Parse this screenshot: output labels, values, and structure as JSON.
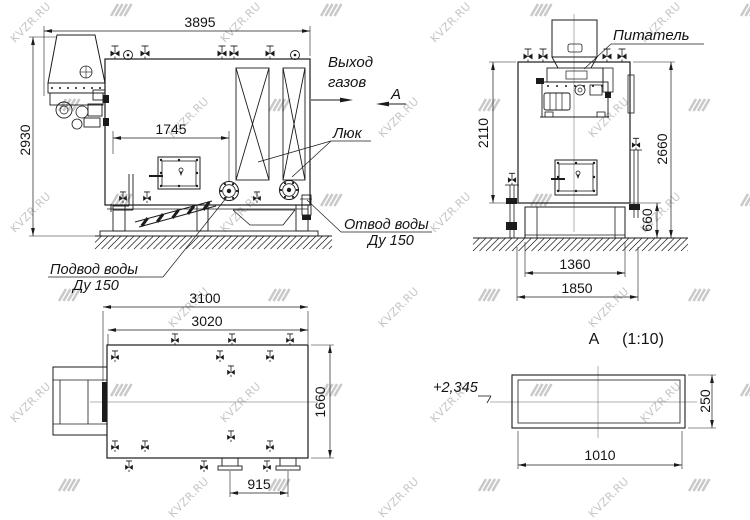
{
  "watermark": {
    "text": "KVZR.RU"
  },
  "front_view": {
    "dim_width": "3895",
    "dim_height": "2930",
    "dim_flange_offset": "1745",
    "label_gas_line1": "Выход",
    "label_gas_line2": "газов",
    "view_arrow_label": "А",
    "label_hatch": "Люк",
    "label_water_outlet_line1": "Отвод воды",
    "label_water_outlet_line2": "Ду 150",
    "label_water_inlet_line1": "Подвод воды",
    "label_water_inlet_line2": "Ду 150"
  },
  "side_view": {
    "label_feeder": "Питатель",
    "dim_body_height": "2110",
    "dim_total_height": "2660",
    "dim_base_height": "660",
    "dim_foundation_inner": "1360",
    "dim_foundation_outer": "1850"
  },
  "plan_view": {
    "dim_total_length": "3100",
    "dim_body_length": "3020",
    "dim_width": "1660",
    "dim_flange_spacing": "915"
  },
  "detail_view": {
    "title": "А",
    "scale": "(1:10)",
    "level_mark": "+2,345",
    "dim_height": "250",
    "dim_length": "1010"
  }
}
